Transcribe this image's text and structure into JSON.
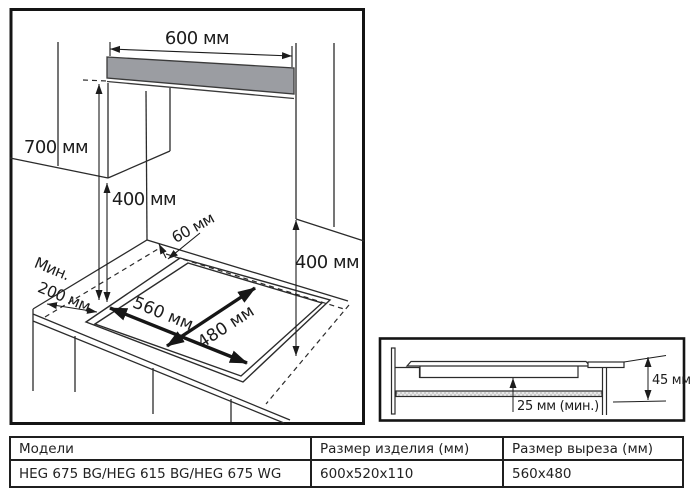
{
  "main_diagram": {
    "labels": {
      "dim_600": "600 мм",
      "dim_700": "700 мм",
      "dim_400_left": "400 мм",
      "dim_60": "60 мм",
      "min_line1": "Мин.",
      "min_line2": "200 мм",
      "dim_560": "560 мм",
      "dim_480": "480 мм",
      "dim_400_right": "400 мм"
    },
    "colors": {
      "hood_gray": "#9b9da2",
      "line": "#2b2b2b"
    }
  },
  "section_diagram": {
    "labels": {
      "dim_45": "45 мм",
      "dim_25": "25 мм (мин.)"
    }
  },
  "table": {
    "headers": [
      "Модели",
      "Размер изделия (мм)",
      "Размер выреза (мм)"
    ],
    "rows": [
      [
        "HEG 675 BG/HEG 615 BG/HEG 675 WG",
        "600x520x110",
        "560x480"
      ]
    ]
  }
}
